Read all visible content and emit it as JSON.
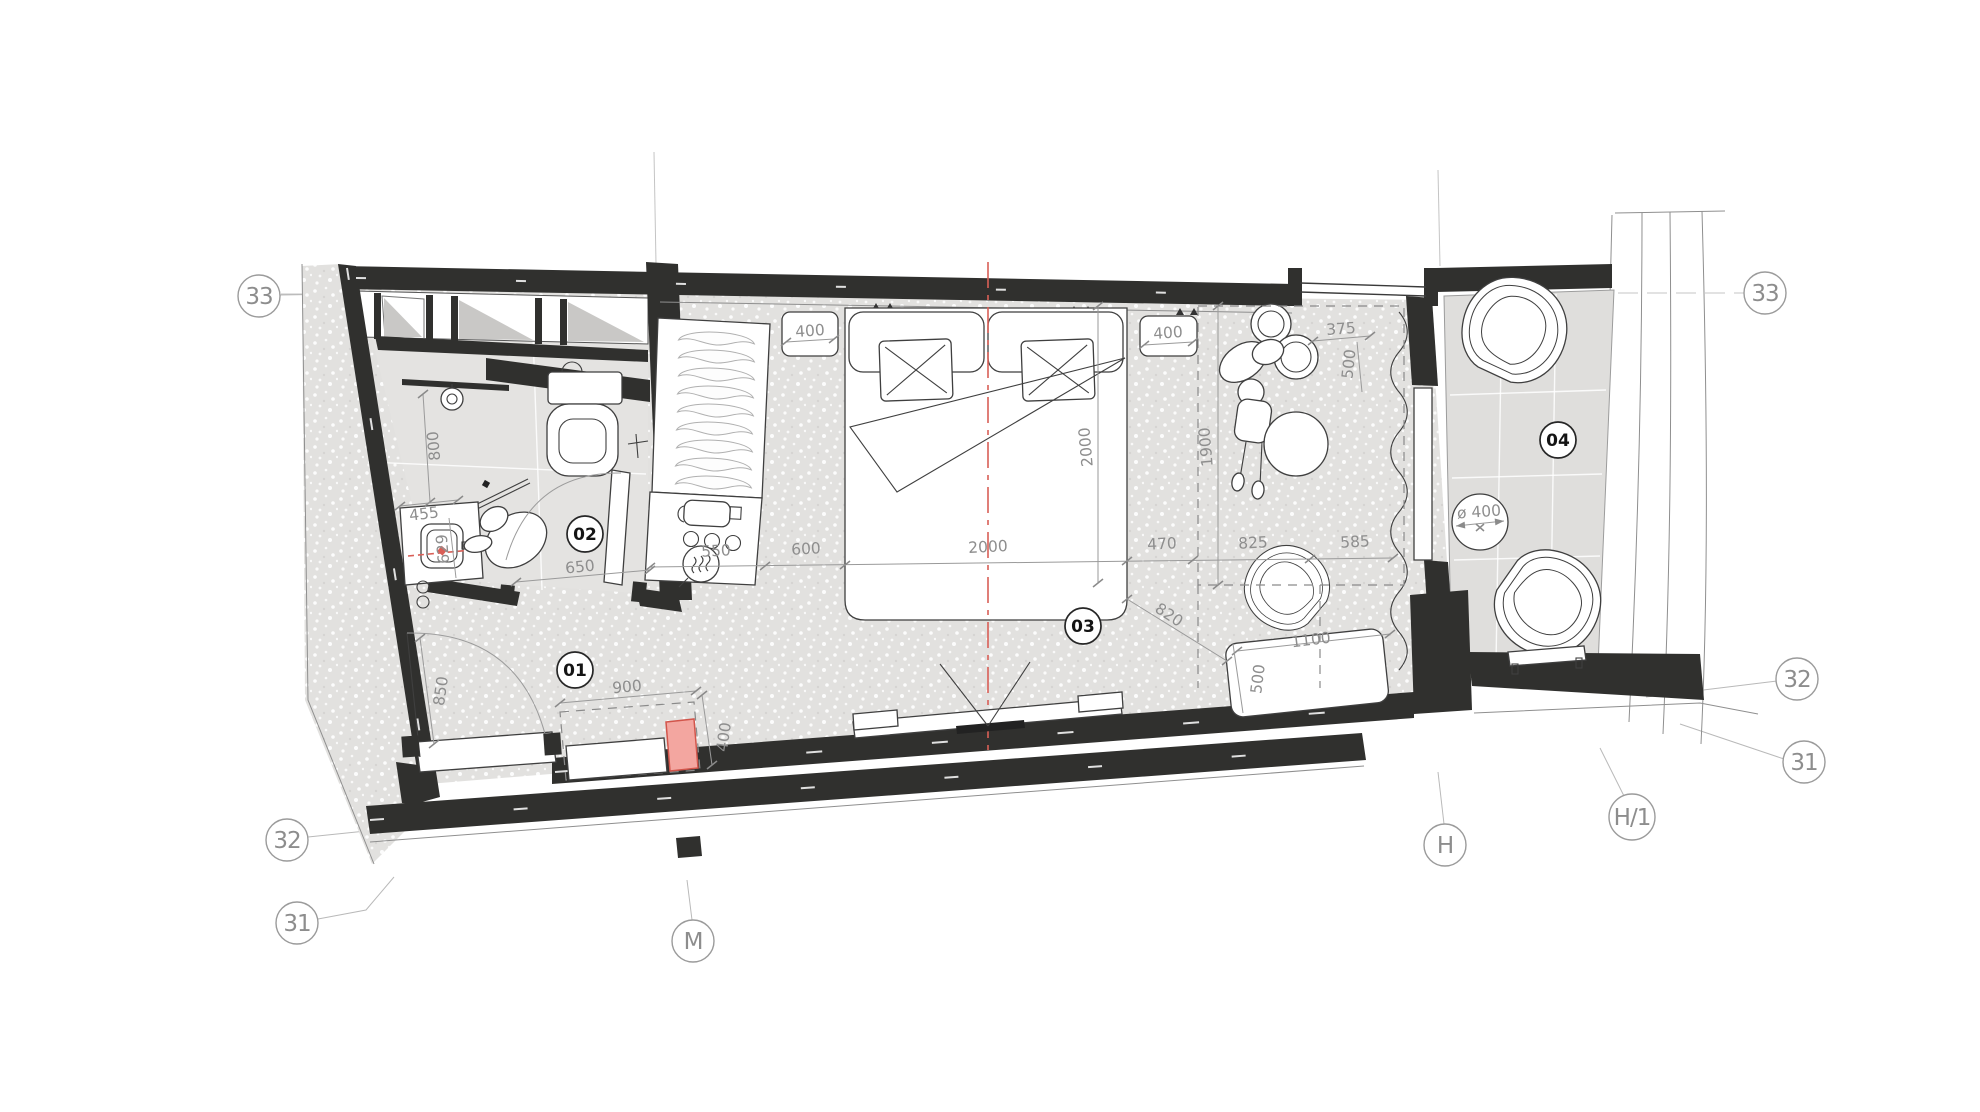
{
  "grid": {
    "l33": "33",
    "r33": "33",
    "l32": "32",
    "r32": "32",
    "l31": "31",
    "r31": "31",
    "mM": "M",
    "mH": "H",
    "mH1": "H/1"
  },
  "rooms": {
    "r01": "01",
    "r02": "02",
    "r03": "03",
    "r04": "04"
  },
  "dims": {
    "shower": "800",
    "vanity_w": "455",
    "vanity_d": "629",
    "bath_door": "650",
    "entry_door": "850",
    "niche_w": "900",
    "niche_d": "400",
    "console": "550",
    "gap": "600",
    "bed_w": "2000",
    "bed_l": "2000",
    "ns_l": "400",
    "ns_r": "400",
    "stool_w": "375",
    "stool_d": "500",
    "zone": "1900",
    "d470": "470",
    "d825": "825",
    "d585": "585",
    "d820": "820",
    "desk_l": "1100",
    "desk_d": "500",
    "table_d": "ø 400"
  },
  "colors": {
    "wall": "#30302e",
    "room_floor": "#e2e1df",
    "bath_floor": "#e4e3e1",
    "balcony_floor": "#dfdedc",
    "accent_red": "#d95f57",
    "highlight_pink": "#f3a6a0",
    "dim_gray": "#8e8e8e"
  }
}
